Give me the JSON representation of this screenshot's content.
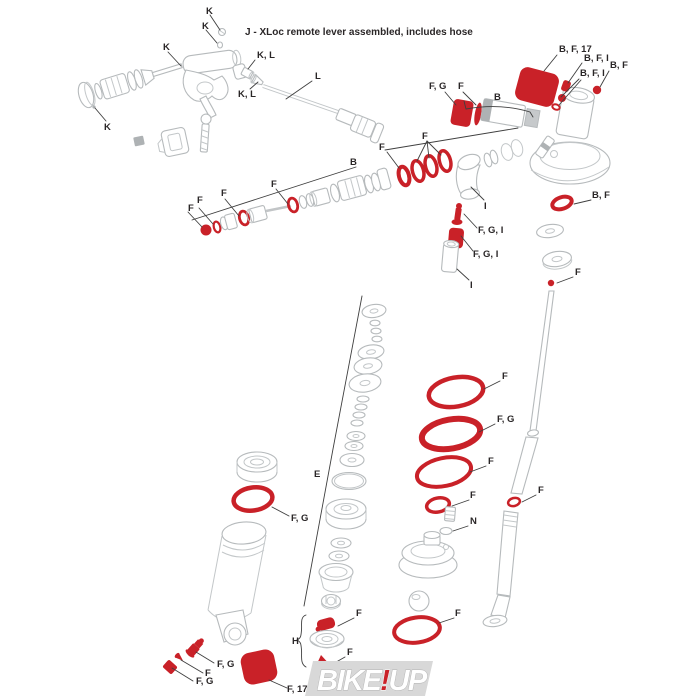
{
  "title": "J - XLoc remote lever assembled, includes hose",
  "labels": {
    "K": "K",
    "KL": "K, L",
    "L": "L",
    "B": "B",
    "F": "F",
    "FG": "F, G",
    "FGI": "F, G, I",
    "I": "I",
    "E": "E",
    "H": "H",
    "N": "N",
    "BF": "B, F",
    "BFI": "B, F, I",
    "BF17": "B, F, 17",
    "F17": "F, 17"
  },
  "logo": {
    "bike": "BIKE",
    "exclaim": "!",
    "up": "UP"
  },
  "colors": {
    "part_red": "#c92128",
    "line_gray": "#b6babc",
    "label_ink": "#2a2627",
    "leader_ink": "#3f3f3f",
    "logo_bg": "#d8d8d8",
    "logo_letter": "#ffffff"
  }
}
